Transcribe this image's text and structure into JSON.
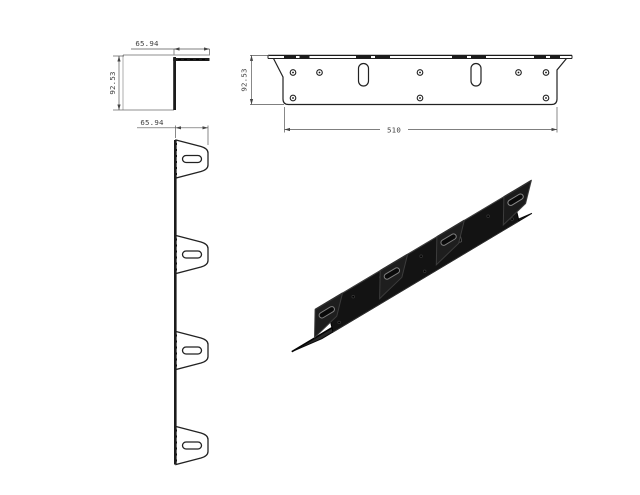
{
  "drawing": {
    "part_name": "L-bracket with slotted mounting tabs",
    "background_color": "#ffffff",
    "outline_color": "#222222",
    "dim_line_color": "#555555",
    "iso_body_color": "#141414",
    "views": {
      "side_profile": {
        "label": "L profile side view",
        "width_dim": "65.94",
        "height_dim": "92.53"
      },
      "tab_side": {
        "label": "side elevation with 4 slotted tabs",
        "width_dim": "65.94",
        "tab_count": 4,
        "slots_per_tab": 1
      },
      "front": {
        "label": "front elevation",
        "height_dim": "92.53",
        "length_dim": "510",
        "top_hole_count": 5,
        "bottom_hole_count": 3,
        "vertical_slot_count": 2
      },
      "isometric": {
        "label": "isometric render",
        "finish": "black"
      }
    }
  }
}
